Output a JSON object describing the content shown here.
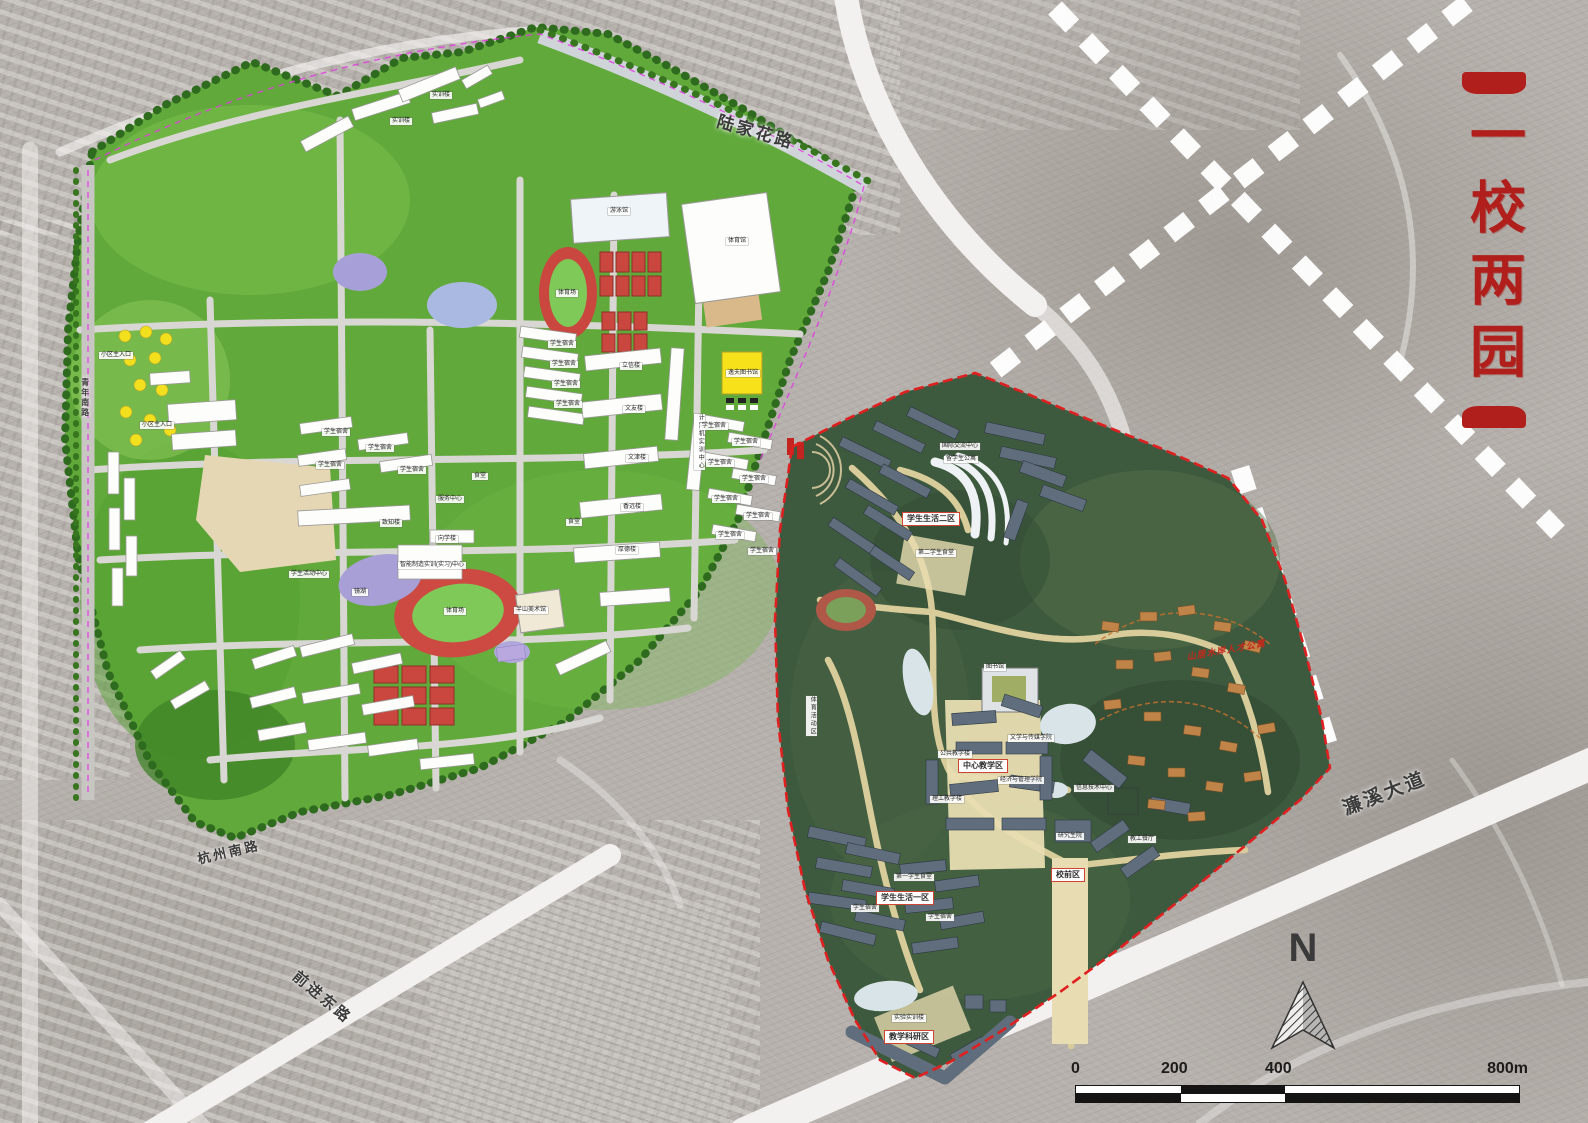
{
  "title": {
    "text": "一校两园"
  },
  "colors": {
    "title_red": "#b01f1c",
    "boundary_red": "#e02020",
    "old_campus_green": "#61a93b",
    "new_campus_green": "#3e5a3e",
    "water_purple": "#a7a0d8",
    "track_red": "#c9473f"
  },
  "legend": {
    "north": "N",
    "scale_ticks": [
      "0",
      "200",
      "400",
      "800m"
    ]
  },
  "roads": [
    {
      "text": "陆家花路",
      "x": 720,
      "y": 112,
      "rot": 16,
      "size": 17,
      "cls": "road"
    },
    {
      "text": "濂溪大道",
      "x": 1340,
      "y": 800,
      "rot": -21,
      "size": 19,
      "cls": "road"
    },
    {
      "text": "前进东路",
      "x": 300,
      "y": 968,
      "rot": 40,
      "size": 15,
      "cls": "road"
    },
    {
      "text": "杭州南路",
      "x": 196,
      "y": 852,
      "rot": -13,
      "size": 13,
      "cls": "road"
    },
    {
      "text": "青年南路",
      "x": 80,
      "y": 378,
      "size": 8,
      "cls": "road",
      "vert": true
    }
  ],
  "left_campus": {
    "labels": [
      {
        "text": "游泳馆",
        "x": 608,
        "y": 208
      },
      {
        "text": "体育馆",
        "x": 726,
        "y": 238
      },
      {
        "text": "体育场",
        "x": 556,
        "y": 290
      },
      {
        "text": "体育场",
        "x": 444,
        "y": 608
      },
      {
        "text": "逸夫图书馆",
        "x": 726,
        "y": 370
      },
      {
        "text": "计算机实训中心",
        "x": 694,
        "y": 414,
        "vert": true
      },
      {
        "text": "立信楼",
        "x": 620,
        "y": 363
      },
      {
        "text": "文友楼",
        "x": 623,
        "y": 406
      },
      {
        "text": "文津楼",
        "x": 626,
        "y": 455
      },
      {
        "text": "香远楼",
        "x": 621,
        "y": 504
      },
      {
        "text": "厚德楼",
        "x": 616,
        "y": 547
      },
      {
        "text": "致知楼",
        "x": 380,
        "y": 520
      },
      {
        "text": "向学楼",
        "x": 436,
        "y": 536
      },
      {
        "text": "服务中心",
        "x": 436,
        "y": 496
      },
      {
        "text": "食堂",
        "x": 472,
        "y": 473
      },
      {
        "text": "食堂",
        "x": 566,
        "y": 519
      },
      {
        "text": "智能制造实训(实习)中心",
        "x": 398,
        "y": 562
      },
      {
        "text": "镜湖",
        "x": 352,
        "y": 589
      },
      {
        "text": "半山美术馆",
        "x": 514,
        "y": 607
      },
      {
        "text": "学生活动中心",
        "x": 289,
        "y": 571
      },
      {
        "text": "实训楼",
        "x": 430,
        "y": 92
      },
      {
        "text": "实训楼",
        "x": 390,
        "y": 118
      },
      {
        "text": "学生宿舍",
        "x": 548,
        "y": 341
      },
      {
        "text": "学生宿舍",
        "x": 550,
        "y": 361
      },
      {
        "text": "学生宿舍",
        "x": 552,
        "y": 381
      },
      {
        "text": "学生宿舍",
        "x": 554,
        "y": 401
      },
      {
        "text": "学生宿舍",
        "x": 322,
        "y": 429
      },
      {
        "text": "学生宿舍",
        "x": 366,
        "y": 445
      },
      {
        "text": "学生宿舍",
        "x": 316,
        "y": 462
      },
      {
        "text": "学生宿舍",
        "x": 398,
        "y": 467
      },
      {
        "text": "学生宿舍",
        "x": 700,
        "y": 423
      },
      {
        "text": "学生宿舍",
        "x": 732,
        "y": 439
      },
      {
        "text": "学生宿舍",
        "x": 706,
        "y": 460
      },
      {
        "text": "学生宿舍",
        "x": 740,
        "y": 476
      },
      {
        "text": "学生宿舍",
        "x": 712,
        "y": 496
      },
      {
        "text": "学生宿舍",
        "x": 744,
        "y": 513
      },
      {
        "text": "学生宿舍",
        "x": 716,
        "y": 532
      },
      {
        "text": "学生宿舍",
        "x": 748,
        "y": 548
      },
      {
        "text": "小区主入口",
        "x": 99,
        "y": 352
      },
      {
        "text": "小区主入口",
        "x": 140,
        "y": 422
      }
    ]
  },
  "right_campus": {
    "labels": [
      {
        "text": "学生生活二区",
        "x": 902,
        "y": 512,
        "cls": "box"
      },
      {
        "text": "学生生活一区",
        "x": 876,
        "y": 891,
        "cls": "box"
      },
      {
        "text": "中心教学区",
        "x": 958,
        "y": 759,
        "cls": "box"
      },
      {
        "text": "校前区",
        "x": 1051,
        "y": 868,
        "cls": "box"
      },
      {
        "text": "教学科研区",
        "x": 884,
        "y": 1030,
        "cls": "box"
      },
      {
        "text": "第二学生食堂",
        "x": 916,
        "y": 550
      },
      {
        "text": "国际交流中心",
        "x": 940,
        "y": 443
      },
      {
        "text": "留学生公寓",
        "x": 944,
        "y": 456
      },
      {
        "text": "图书馆",
        "x": 984,
        "y": 664
      },
      {
        "text": "文学与传媒学院",
        "x": 1008,
        "y": 735
      },
      {
        "text": "公共教学楼",
        "x": 938,
        "y": 751
      },
      {
        "text": "经济与管理学院",
        "x": 998,
        "y": 777
      },
      {
        "text": "理工教学楼",
        "x": 930,
        "y": 796
      },
      {
        "text": "信息技术中心",
        "x": 1074,
        "y": 785
      },
      {
        "text": "教工餐厅",
        "x": 1128,
        "y": 836
      },
      {
        "text": "研究生院",
        "x": 1056,
        "y": 833
      },
      {
        "text": "第一学生食堂",
        "x": 894,
        "y": 874
      },
      {
        "text": "学生宿舍",
        "x": 851,
        "y": 905
      },
      {
        "text": "学生宿舍",
        "x": 926,
        "y": 914
      },
      {
        "text": "实验实训楼",
        "x": 892,
        "y": 1015
      },
      {
        "text": "体育活动区",
        "x": 806,
        "y": 696,
        "vert": true
      },
      {
        "text": "山居水岸人才公寓",
        "x": 1186,
        "y": 652,
        "cls": "red-it",
        "rot": -10
      }
    ]
  }
}
